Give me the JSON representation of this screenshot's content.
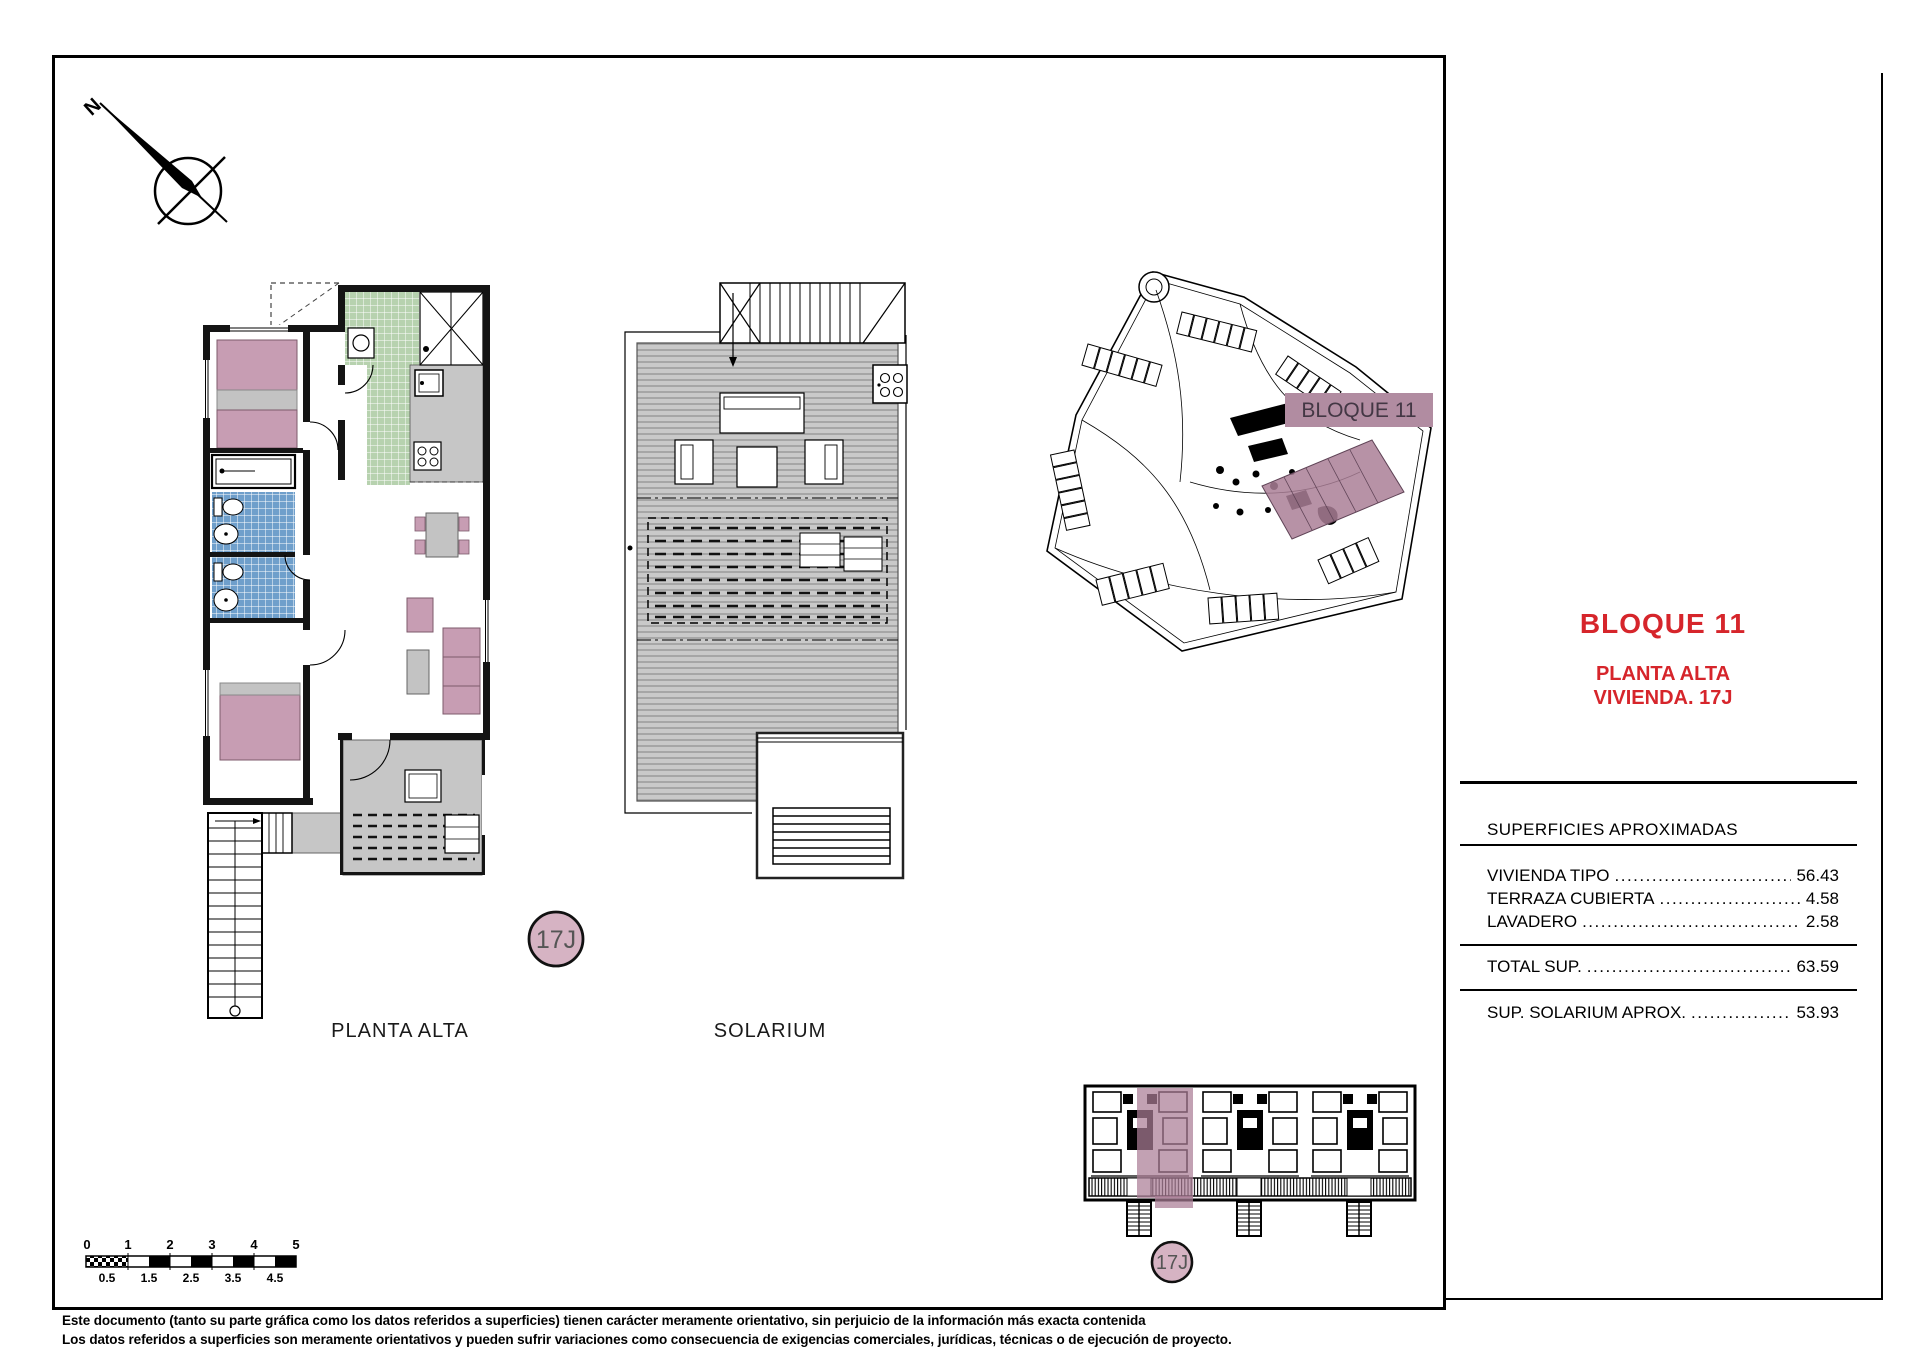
{
  "compass": {
    "north_label": "N"
  },
  "plans": {
    "planta_alta_caption": "PLANTA ALTA",
    "solarium_caption": "SOLARIUM",
    "unit_badge": "17J"
  },
  "site_plan": {
    "block_label": "BLOQUE 11"
  },
  "panel": {
    "title": "BLOQUE 11",
    "subtitle_line1": "PLANTA ALTA",
    "subtitle_line2": "VIVIENDA. 17J",
    "table": {
      "header": "SUPERFICIES APROXIMADAS",
      "rows": [
        {
          "label": "VIVIENDA TIPO",
          "value": "56.43"
        },
        {
          "label": "TERRAZA CUBIERTA",
          "value": "4.58"
        },
        {
          "label": "LAVADERO",
          "value": "2.58"
        }
      ],
      "total": {
        "label": "TOTAL SUP.",
        "value": "63.59"
      },
      "solarium": {
        "label": "SUP. SOLARIUM APROX.",
        "value": "53.93"
      }
    }
  },
  "scalebar": {
    "top": [
      "0",
      "1",
      "2",
      "3",
      "4",
      "5"
    ],
    "bottom": [
      "0.5",
      "1.5",
      "2.5",
      "3.5",
      "4.5"
    ]
  },
  "disclaimer": {
    "line1": "Este documento (tanto su parte gráfica como los datos referidos a superficies) tienen carácter meramente orientativo, sin perjuicio de la información más exacta contenida",
    "line2": "Los datos referidos a superficies son meramente orientativos y pueden sufrir variaciones como consecuencia de exigencias comerciales, jurídicas, técnicas o de ejecución de proyecto."
  },
  "colors": {
    "accent_red": "#d6252b",
    "highlight_mauve": "#b18ca1",
    "furniture_pink": "#c79db3",
    "tile_blue": "#6f9fcb",
    "tile_green": "#b7d2af",
    "deck_gray": "#c6c6c6"
  }
}
